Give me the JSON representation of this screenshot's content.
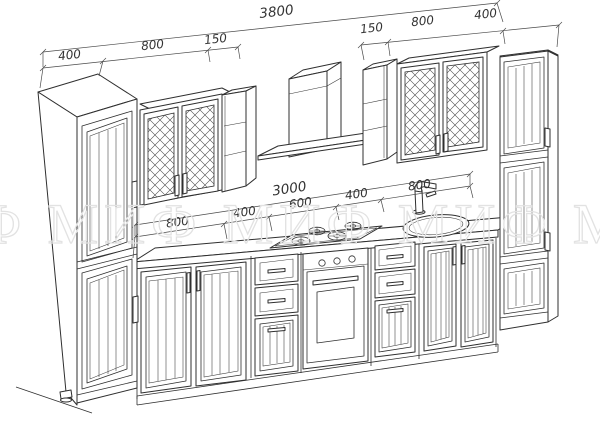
{
  "drawing": {
    "watermark_text": "МИФ МИФ МИФ МИФ МИФ",
    "dims": {
      "top_total": "3800",
      "top_left": [
        "400",
        "800",
        "150"
      ],
      "top_right": [
        "150",
        "800",
        "400"
      ],
      "mid_total": "3000",
      "mid_segments": [
        "800",
        "400",
        "600",
        "400",
        "800"
      ]
    },
    "colors": {
      "background": "#ffffff",
      "line": "#2f2f2f",
      "dimension": "#3a3a3a",
      "watermark": "#e2e2e2"
    }
  }
}
